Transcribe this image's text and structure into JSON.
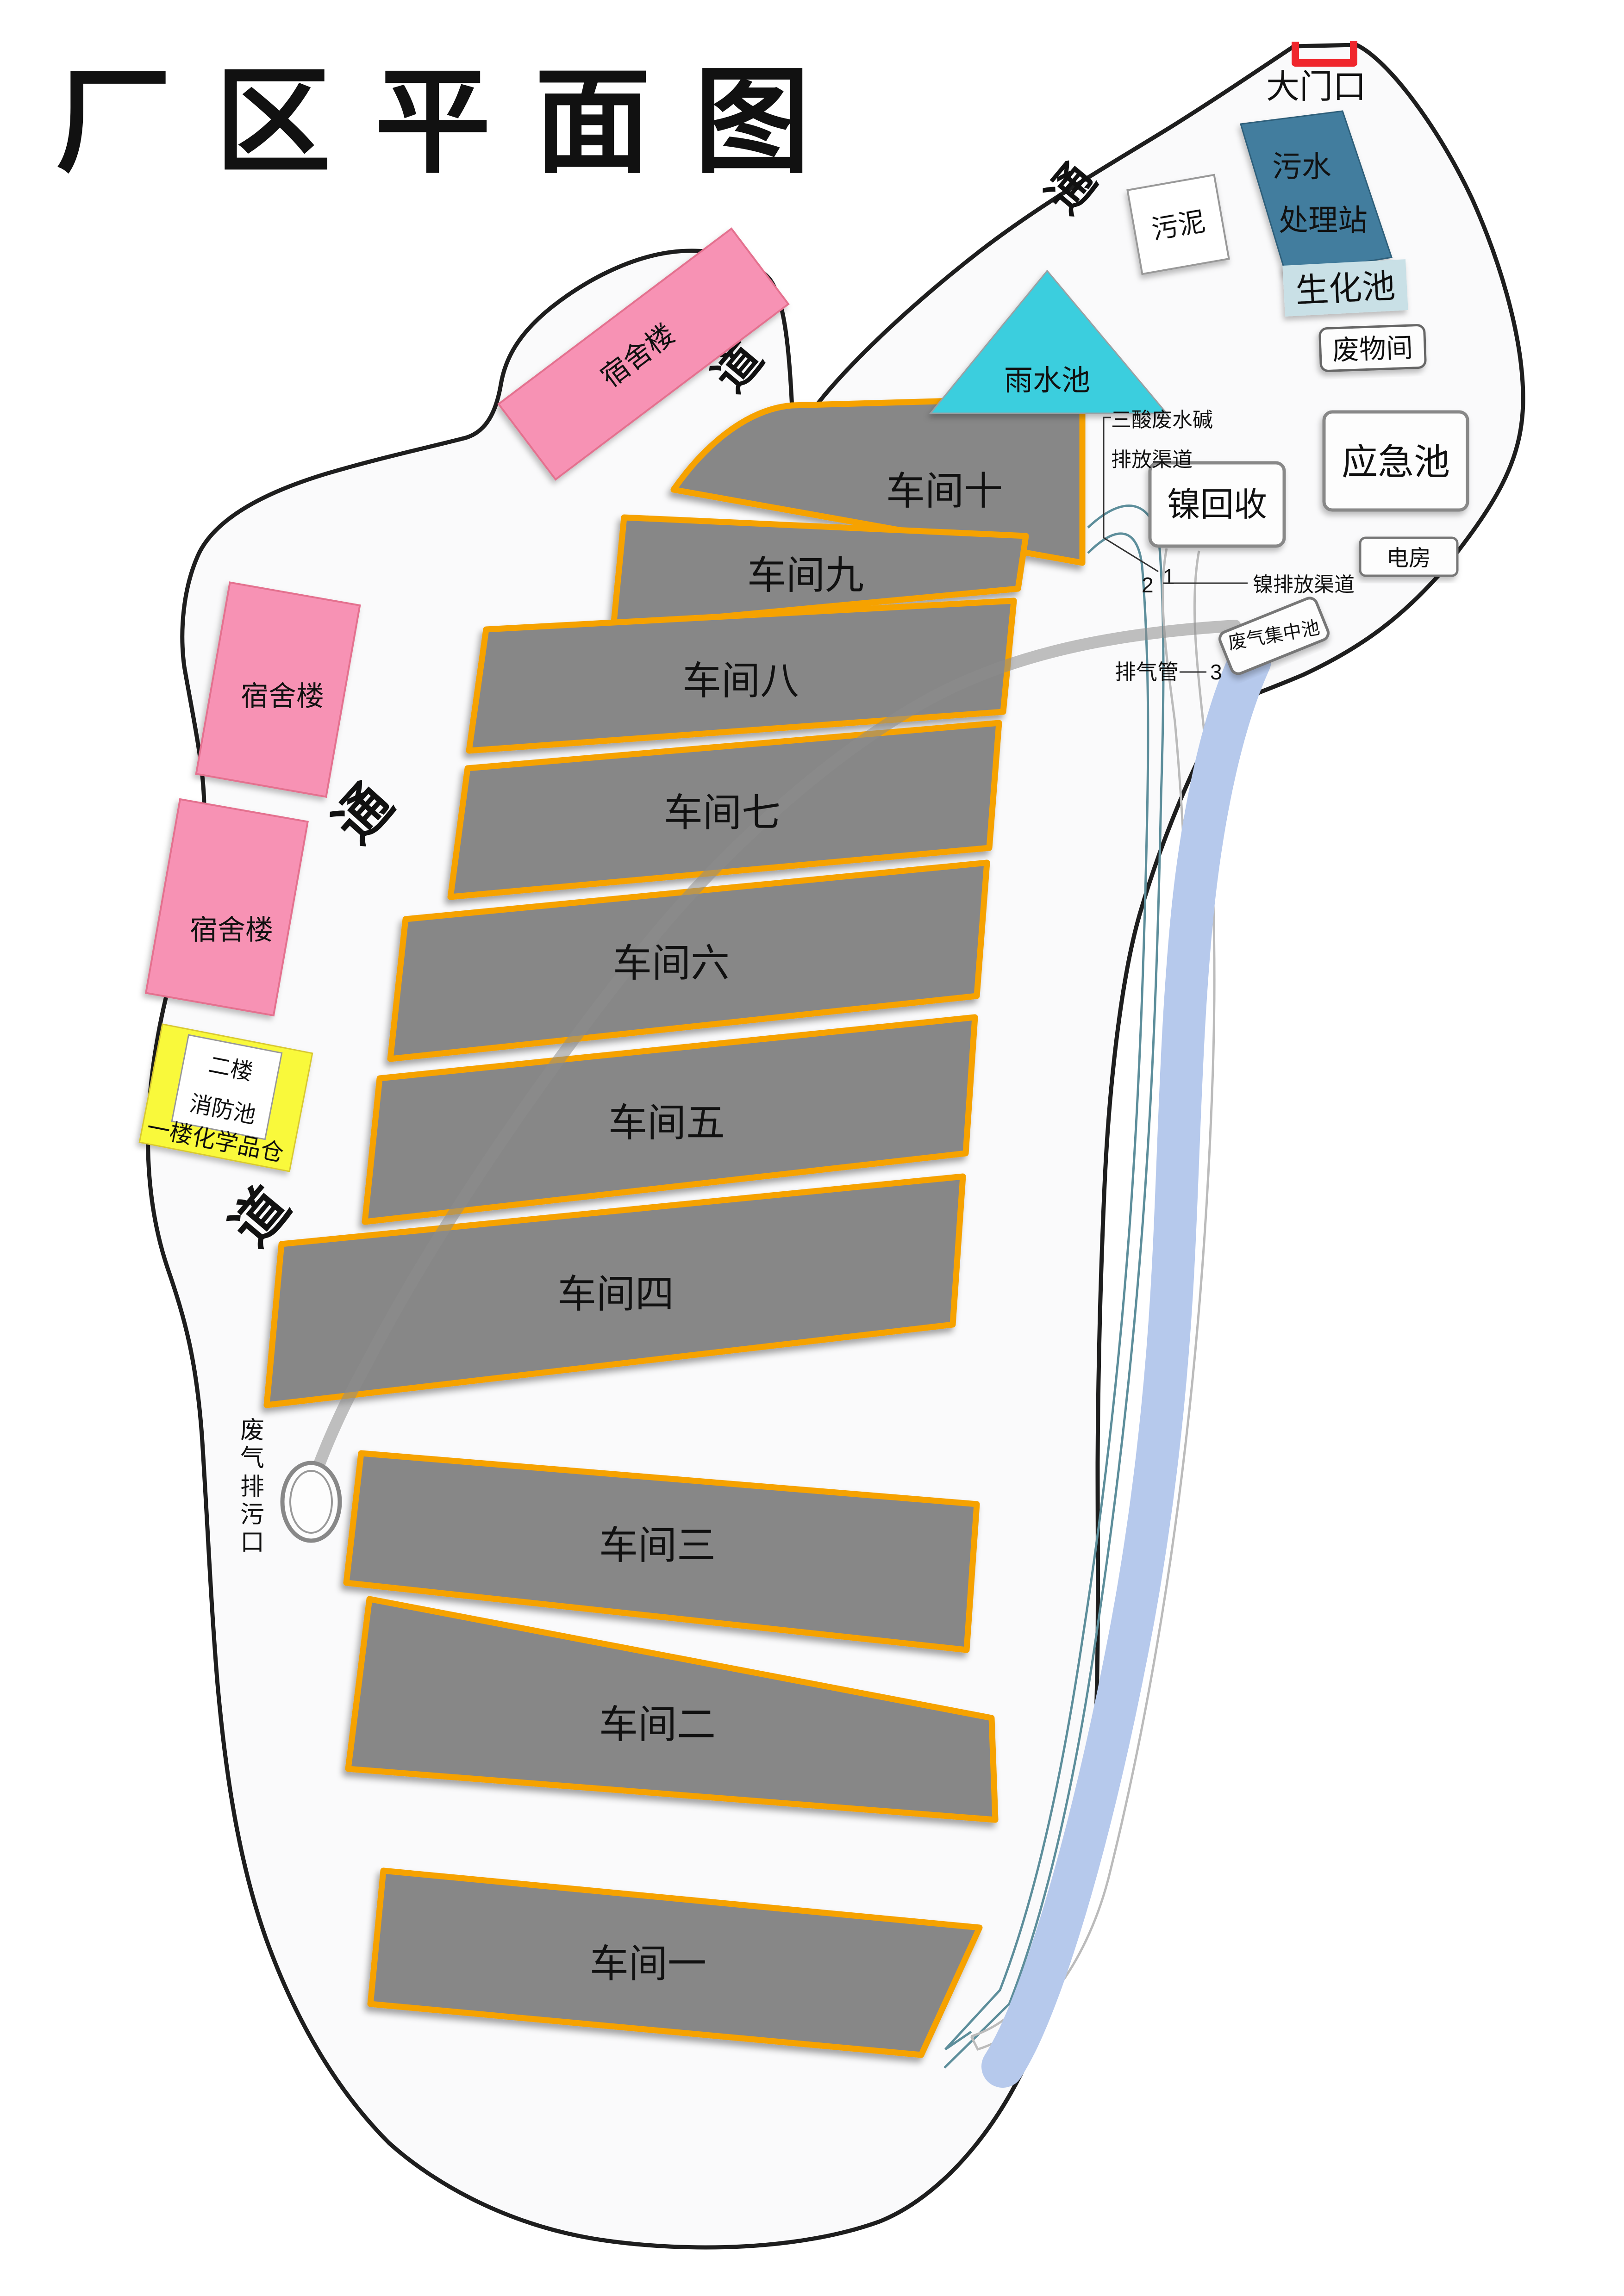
{
  "title": "厂区平面图",
  "gate": {
    "label": "大门口"
  },
  "roads": {
    "tong_top": "通",
    "dao_top": "道",
    "tong_left": "通",
    "dao_left": "道"
  },
  "workshops": [
    {
      "label": "车间十"
    },
    {
      "label": "车间九"
    },
    {
      "label": "车间八"
    },
    {
      "label": "车间七"
    },
    {
      "label": "车间六"
    },
    {
      "label": "车间五"
    },
    {
      "label": "车间四"
    },
    {
      "label": "车间三"
    },
    {
      "label": "车间二"
    },
    {
      "label": "车间一"
    }
  ],
  "dorms": {
    "top": "宿舍楼",
    "mid": "宿舍楼",
    "lower": "宿舍楼"
  },
  "chem_building": {
    "floor2": "二楼",
    "pool": "消防池",
    "floor1": "一楼化学品仓"
  },
  "facilities": {
    "sewage_line1": "污水",
    "sewage_line2": "处理站",
    "sludge": "污泥",
    "biochem": "生化池",
    "waste_room": "废物间",
    "rain_pool": "雨水池",
    "emergency_pool": "应急池",
    "nickel_recovery": "镍回收",
    "power_room": "电房",
    "gas_pool": "废气集中池"
  },
  "channels": {
    "acid_line1": "三酸废水碱",
    "acid_line2": "排放渠道",
    "acid_marker": "1",
    "nickel_label": "镍排放渠道",
    "nickel_marker": "2",
    "exhaust_label": "排气管",
    "exhaust_marker": "3"
  },
  "outlet": {
    "chars": [
      "废",
      "气",
      "排",
      "污",
      "口"
    ]
  },
  "colors": {
    "workshop": "#878787",
    "workshopBorder": "#F6A201",
    "boundary": "#1E1E1E",
    "blobFill": "#FAFAFB",
    "pink": "#F792B4",
    "pinkBorder": "#E4718F",
    "yellow": "#F9F93B",
    "cyan": "#3BCEDE",
    "steelBlue": "#427D9E",
    "lightBlue": "#C9E0E6",
    "blueBand": "#B6C9EC",
    "tealLine": "#5D8E9B",
    "grayLine": "#BBBBBB",
    "grayPipe": "#8C8C8C",
    "red": "#F0262C",
    "boxFill": "#FDFDFD",
    "boxBorder": "#888888"
  }
}
